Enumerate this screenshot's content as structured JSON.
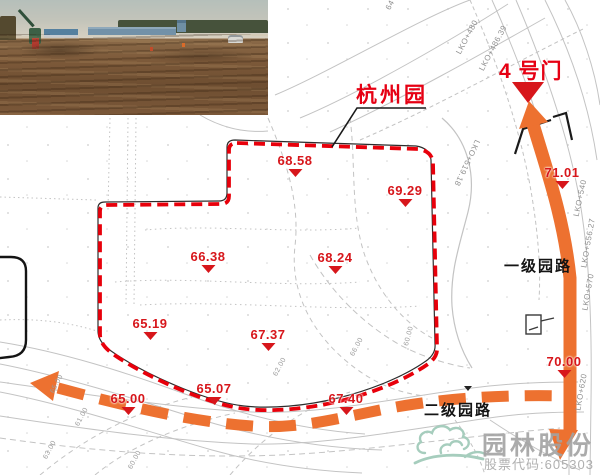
{
  "labels": {
    "garden": "杭州园",
    "gate": "4 号门",
    "primary_road": "一级园路",
    "secondary_road": "二级园路"
  },
  "elevations": [
    {
      "v": "68.58",
      "x": 295,
      "y": 154
    },
    {
      "v": "69.29",
      "x": 405,
      "y": 184
    },
    {
      "v": "66.38",
      "x": 208,
      "y": 250
    },
    {
      "v": "68.24",
      "x": 335,
      "y": 251
    },
    {
      "v": "65.19",
      "x": 150,
      "y": 317
    },
    {
      "v": "67.37",
      "x": 268,
      "y": 328
    },
    {
      "v": "65.07",
      "x": 214,
      "y": 382
    },
    {
      "v": "65.00",
      "x": 128,
      "y": 392
    },
    {
      "v": "67.40",
      "x": 346,
      "y": 392
    },
    {
      "v": "71.01",
      "x": 562,
      "y": 166
    },
    {
      "v": "70.00",
      "x": 564,
      "y": 355
    }
  ],
  "stations": [
    {
      "t": "LKO+480",
      "x": 467,
      "y": 37,
      "r": -62
    },
    {
      "t": "LKO+486.39",
      "x": 493,
      "y": 48,
      "r": -62
    },
    {
      "t": "64",
      "x": 390,
      "y": 5,
      "r": -62
    },
    {
      "t": "LKO+519.18",
      "x": 467,
      "y": 163,
      "r": 115
    },
    {
      "t": "LKO+540",
      "x": 580,
      "y": 198,
      "r": -78
    },
    {
      "t": "LKO+556.27",
      "x": 588,
      "y": 243,
      "r": -80
    },
    {
      "t": "LKO+570",
      "x": 588,
      "y": 292,
      "r": -80
    },
    {
      "t": "LKO+620",
      "x": 581,
      "y": 392,
      "r": -80
    }
  ],
  "contours": [
    {
      "t": "65.00",
      "x": 57,
      "y": 384,
      "r": -62
    },
    {
      "t": "61.00",
      "x": 82,
      "y": 417,
      "r": -62
    },
    {
      "t": "63.00",
      "x": 50,
      "y": 450,
      "r": -62
    },
    {
      "t": "60.00",
      "x": 135,
      "y": 460,
      "r": -62
    },
    {
      "t": "62.00",
      "x": 280,
      "y": 367,
      "r": -62
    },
    {
      "t": "66.00",
      "x": 357,
      "y": 347,
      "r": -62
    },
    {
      "t": "60.00",
      "x": 409,
      "y": 336,
      "r": -75
    }
  ],
  "watermark": {
    "name": "园林股份",
    "code": "股票代码:605303"
  },
  "colors": {
    "route_orange": "#ed7130",
    "label_red": "#e60013",
    "marker_red": "#d7161b",
    "boundary_red": "#e8000b",
    "road_text_black": "#141414",
    "watermark_gray": "#a2a2a2",
    "logo_green": "#a6cdbd"
  }
}
